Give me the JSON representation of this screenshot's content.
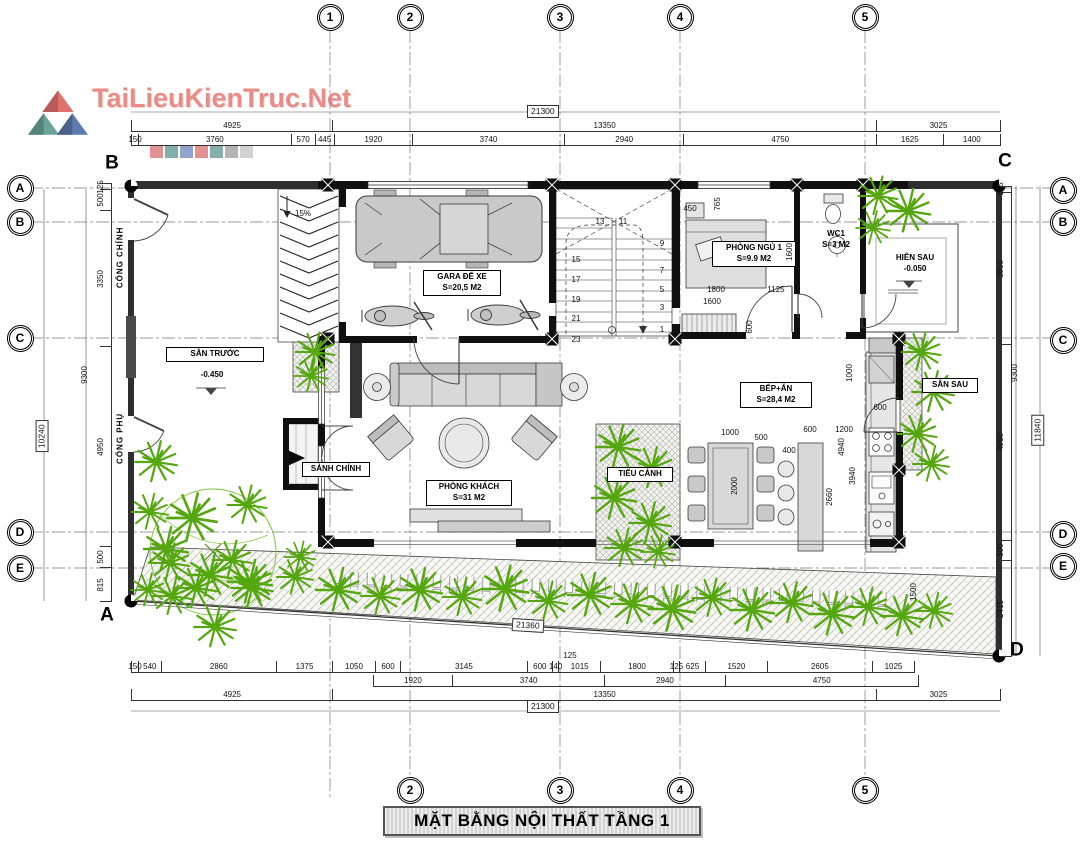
{
  "watermark": {
    "text": "TaiLieuKienTruc.Net"
  },
  "title": "MẶT BẰNG NỘI THẤT TẦNG 1",
  "corner_marks": [
    {
      "label": "B",
      "x": 112,
      "y": 163
    },
    {
      "label": "C",
      "x": 1005,
      "y": 161
    },
    {
      "label": "A",
      "x": 107,
      "y": 615
    },
    {
      "label": "D",
      "x": 1017,
      "y": 650
    }
  ],
  "grid_bubbles": [
    {
      "label": "1",
      "x": 330,
      "y": 17
    },
    {
      "label": "2",
      "x": 410,
      "y": 17
    },
    {
      "label": "3",
      "x": 560,
      "y": 17
    },
    {
      "label": "4",
      "x": 680,
      "y": 17
    },
    {
      "label": "5",
      "x": 865,
      "y": 17
    },
    {
      "label": "2",
      "x": 410,
      "y": 790
    },
    {
      "label": "3",
      "x": 560,
      "y": 790
    },
    {
      "label": "4",
      "x": 680,
      "y": 790
    },
    {
      "label": "5",
      "x": 865,
      "y": 790
    },
    {
      "label": "A",
      "x": 20,
      "y": 188
    },
    {
      "label": "B",
      "x": 20,
      "y": 222
    },
    {
      "label": "C",
      "x": 20,
      "y": 338
    },
    {
      "label": "D",
      "x": 20,
      "y": 532
    },
    {
      "label": "E",
      "x": 20,
      "y": 568
    },
    {
      "label": "A",
      "x": 1063,
      "y": 190
    },
    {
      "label": "B",
      "x": 1063,
      "y": 222
    },
    {
      "label": "C",
      "x": 1063,
      "y": 340
    },
    {
      "label": "D",
      "x": 1063,
      "y": 534
    },
    {
      "label": "E",
      "x": 1063,
      "y": 566
    }
  ],
  "rooms": {
    "garage": {
      "name": "GARA ĐỂ XE",
      "area": "S=20,5 M2"
    },
    "bedroom1": {
      "name": "PHÒNG NGỦ 1",
      "area": "S=9.9 M2"
    },
    "wc1": {
      "name": "WC1",
      "area": "S=3 M2"
    },
    "back_porch": {
      "name": "HIÊN SAU",
      "level": "-0.050"
    },
    "front_yard": {
      "name": "SÂN TRƯỚC",
      "level": "-0.450"
    },
    "main_gate": {
      "name": "CỔNG CHÍNH"
    },
    "side_gate": {
      "name": "CỔNG PHỤ"
    },
    "main_hall": {
      "name": "SẢNH CHÍNH"
    },
    "living_room": {
      "name": "PHÒNG KHÁCH",
      "area": "S=31 M2"
    },
    "mini_garden": {
      "name": "TIỂU CẢNH"
    },
    "kitchen_dining": {
      "name": "BẾP+ĂN",
      "area": "S=28,4 M2"
    },
    "back_yard": {
      "name": "SÂN SAU"
    }
  },
  "dims": {
    "top_total": "21300",
    "top_row2": [
      4925,
      13350,
      3025
    ],
    "top_row3": [
      150,
      3760,
      570,
      445,
      1920,
      3740,
      2940,
      4750,
      1625,
      1400
    ],
    "bottom_row1": [
      150,
      540,
      2860,
      1375,
      1050,
      600,
      3145,
      600,
      140,
      1015,
      1800,
      125,
      625,
      1520,
      2605,
      1025
    ],
    "bottom_row2": [
      1920,
      3740,
      2940,
      4750
    ],
    "bottom_row3": [
      4925,
      13350,
      3025
    ],
    "bottom_total": "21300",
    "left_col": [
      125,
      500,
      3350,
      4950,
      500,
      815
    ],
    "left_mid": "9300",
    "left_total": "10240",
    "right_col": [
      125,
      3850,
      4950,
      500,
      2415
    ],
    "right_mid": "9300",
    "right_total": "11840",
    "boundary_bottom": "21360"
  },
  "annotations": [
    {
      "t": "13",
      "x": 600,
      "y": 222
    },
    {
      "t": "11",
      "x": 623,
      "y": 222
    },
    {
      "t": "15",
      "x": 576,
      "y": 260
    },
    {
      "t": "17",
      "x": 576,
      "y": 280
    },
    {
      "t": "19",
      "x": 576,
      "y": 300
    },
    {
      "t": "21",
      "x": 576,
      "y": 319
    },
    {
      "t": "23",
      "x": 576,
      "y": 340
    },
    {
      "t": "9",
      "x": 662,
      "y": 244
    },
    {
      "t": "7",
      "x": 662,
      "y": 271
    },
    {
      "t": "5",
      "x": 662,
      "y": 290
    },
    {
      "t": "3",
      "x": 662,
      "y": 308
    },
    {
      "t": "1",
      "x": 662,
      "y": 330
    },
    {
      "t": "15%",
      "x": 303,
      "y": 214
    },
    {
      "t": "450",
      "x": 690,
      "y": 209
    },
    {
      "t": "765",
      "x": 718,
      "y": 204,
      "r": -90
    },
    {
      "t": "1600",
      "x": 790,
      "y": 252,
      "r": -90
    },
    {
      "t": "1800",
      "x": 716,
      "y": 290
    },
    {
      "t": "1125",
      "x": 776,
      "y": 290
    },
    {
      "t": "1600",
      "x": 712,
      "y": 302
    },
    {
      "t": "600",
      "x": 750,
      "y": 327,
      "r": -90
    },
    {
      "t": "1000",
      "x": 730,
      "y": 433
    },
    {
      "t": "500",
      "x": 761,
      "y": 438
    },
    {
      "t": "2000",
      "x": 735,
      "y": 486,
      "r": -90
    },
    {
      "t": "400",
      "x": 789,
      "y": 451
    },
    {
      "t": "600",
      "x": 810,
      "y": 430
    },
    {
      "t": "1200",
      "x": 844,
      "y": 430
    },
    {
      "t": "4940",
      "x": 842,
      "y": 447,
      "r": -90
    },
    {
      "t": "3940",
      "x": 853,
      "y": 476,
      "r": -90
    },
    {
      "t": "2660",
      "x": 830,
      "y": 497,
      "r": -90
    },
    {
      "t": "1000",
      "x": 850,
      "y": 373,
      "r": -90
    },
    {
      "t": "600",
      "x": 880,
      "y": 408
    },
    {
      "t": "1500",
      "x": 914,
      "y": 592,
      "r": -90
    },
    {
      "t": "125",
      "x": 570,
      "y": 656
    }
  ]
}
